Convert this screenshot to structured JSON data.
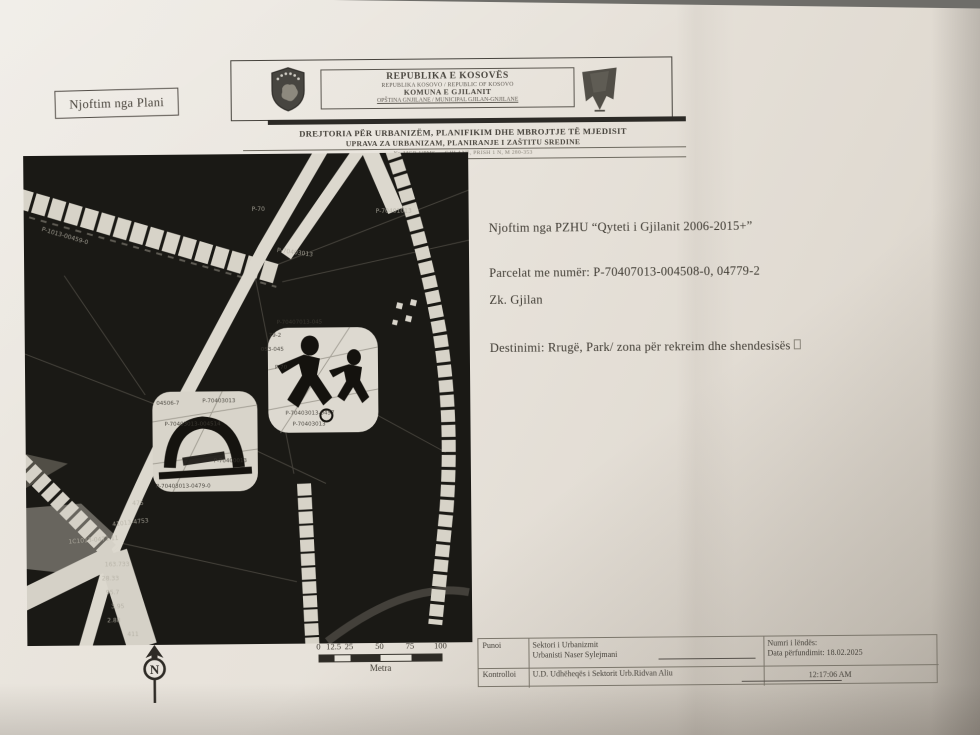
{
  "corner_label": {
    "text": "Njoftim nga Plani"
  },
  "letterhead": {
    "republic": "REPUBLIKA E KOSOVËS",
    "republic_sub": "REPUBLIKA KOSOVO / REPUBLIC OF KOSOVO",
    "municipality": "KOMUNA E GJILANIT",
    "municipality_sub": "OPŠTINA GNJILANE / MUNICIPAL GJILAN-GNJILANE",
    "directorate_sq": "DREJTORIA  PËR URBANIZËM, PLANIFIKIM DHE MBROJTJE TË MJEDISIT",
    "directorate_sr": "UPRAVA ZA URBANIZAM, PLANIRANJE I ZAŠTITU SREDINE",
    "address_line": "Nr. MGR-UPMS — GJILANE, PRISH 1 N, M 280-353"
  },
  "notice": {
    "title": "Njoftim nga PZHU “Qyteti i Gjilanit 2006-2015+”",
    "parcels": "Parcelat me numër: P-70407013-004508-0,  04779-2",
    "zone": "Zk. Gjilan",
    "destination": "Destinimi: Rrugë, Park/ zona për rekreim dhe shendesisës"
  },
  "map": {
    "labels": [
      {
        "text": "P-1013-00459-0",
        "x": 18,
        "y": 70,
        "rot": 17
      },
      {
        "text": "P-70",
        "x": 228,
        "y": 52
      },
      {
        "text": "P-70401013",
        "x": 352,
        "y": 55
      },
      {
        "text": "P-70403013",
        "x": 253,
        "y": 93,
        "rot": 8
      },
      {
        "text": "P-70407013-045",
        "x": 252,
        "y": 166,
        "dark": true
      },
      {
        "text": "79-2",
        "x": 244,
        "y": 179,
        "dark": true
      },
      {
        "text": "053-045",
        "x": 236,
        "y": 193,
        "dark": true
      },
      {
        "text": "P-70",
        "x": 250,
        "y": 211,
        "dark": true
      },
      {
        "text": "P-70403013-0457",
        "x": 260,
        "y": 257,
        "dark": true
      },
      {
        "text": "P-70403013",
        "x": 267,
        "y": 268,
        "dark": true
      },
      {
        "text": "04506-7",
        "x": 131,
        "y": 246,
        "dark": true
      },
      {
        "text": "P-70403013",
        "x": 177,
        "y": 244,
        "dark": true
      },
      {
        "text": "P-70403013-004514",
        "x": 139,
        "y": 267,
        "dark": true
      },
      {
        "text": "P-70400013",
        "x": 188,
        "y": 304,
        "dark": true
      },
      {
        "text": "P-70403013-0479-0",
        "x": 130,
        "y": 329,
        "dark": true
      },
      {
        "text": "41013-4753",
        "x": 86,
        "y": 366,
        "rot": -6
      },
      {
        "text": "475",
        "x": 106,
        "y": 345
      },
      {
        "text": "1C1013-0471 11",
        "x": 42,
        "y": 383,
        "rot": -4
      },
      {
        "text": "163.733",
        "x": 78,
        "y": 406
      },
      {
        "text": "28.33",
        "x": 75,
        "y": 420
      },
      {
        "text": "95.7",
        "x": 79,
        "y": 434
      },
      {
        "text": "3.95",
        "x": 84,
        "y": 448
      },
      {
        "text": "2.88",
        "x": 80,
        "y": 462
      },
      {
        "text": "411",
        "x": 100,
        "y": 476
      }
    ]
  },
  "scalebar": {
    "ticks": [
      {
        "label": "0",
        "value": 0
      },
      {
        "label": "12.5",
        "value": 12.5
      },
      {
        "label": "25",
        "value": 25
      },
      {
        "label": "50",
        "value": 50
      },
      {
        "label": "75",
        "value": 75
      },
      {
        "label": "100",
        "value": 100
      }
    ],
    "unit": "Metra"
  },
  "north": {
    "letter": "N"
  },
  "approval_table": {
    "r1c1": "Punoi",
    "r1c2a": "Sektori i Urbanizmit",
    "r1c2b": "Urbanisti Naser Sylejmani",
    "r1c3a": "Numri i lëndës:",
    "r1c3b": "Data përfundimit: 18.02.2025",
    "r2c1": "Kontrolloi",
    "r2c2": "U.D. Udhëheqës i Sektorit Urb.Ridvan Aliu",
    "r2c3": "12:17:06 AM"
  }
}
